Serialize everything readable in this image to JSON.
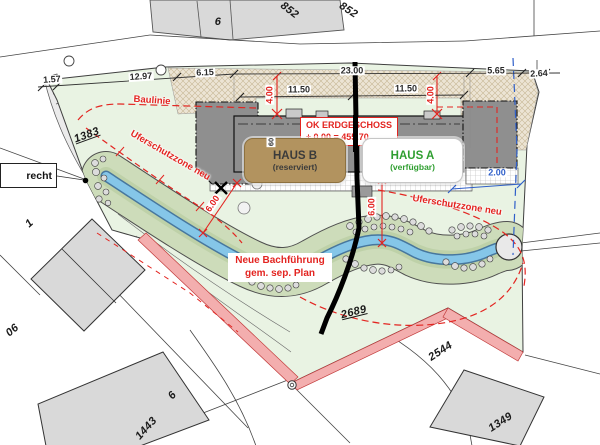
{
  "colors": {
    "annotation_red": "#e32420",
    "available_green": "#2f9e30",
    "badge_tan": "#b2935f",
    "stream_blue": "#85c6e8",
    "site_green": "#e9f3e3",
    "buffer_green": "#cddcba",
    "path_pink": "#f3aeae",
    "dimension_blue": "#2f5fc9"
  },
  "buildings": {
    "haus_a": {
      "name": "HAUS A",
      "status": "(verfügbar)"
    },
    "haus_b": {
      "name": "HAUS B",
      "status": "(reserviert)"
    },
    "level_note": {
      "line1": "OK ERDGESCHOSS",
      "line2": "± 0.00 = 455.70"
    },
    "wall_dim": "60"
  },
  "annotations": {
    "baulinie": "Baulinie",
    "ufer_left": "Uferschutzzone neu",
    "ufer_right": "Uferschutzzone neu",
    "bach_line1": "Neue Bachführung",
    "bach_line2": "gem. sep. Plan",
    "recht": "recht"
  },
  "parcels": {
    "top_6": "6",
    "p852_left": "852",
    "p852_right": "852",
    "p1383": "1383",
    "p1": "1",
    "p06": "06",
    "p2689": "2689",
    "p2544": "2544",
    "p1349": "1349",
    "p1443": "1443",
    "bottom_6": "6"
  },
  "dimensions": {
    "w1": "1.57",
    "w2": "12.97",
    "w3": "6.15",
    "w4": "23.00",
    "w5": "5.65",
    "w6": "2.64",
    "haus_b_width": "11.50",
    "haus_a_width": "11.50",
    "depth_left": "4.00",
    "depth_right": "4.00",
    "buffer_left": "6.00",
    "buffer_right": "6.00",
    "east_offset": "2.00"
  }
}
